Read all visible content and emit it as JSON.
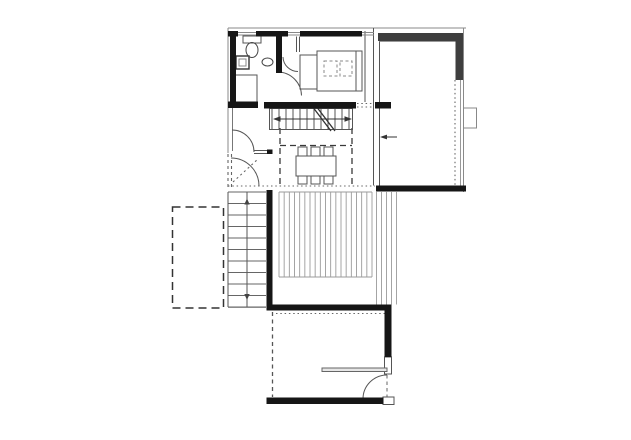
{
  "meta": {
    "canvas_width": 631,
    "canvas_height": 440,
    "background": "#ffffff",
    "drawing_type": "architectural-floor-plan"
  },
  "palette": {
    "wall_black": "#161616",
    "wall_gray": "#3e3e3e",
    "line": "#555555",
    "line_light": "#979797",
    "line_faint": "#8a8a8a",
    "dash": "#3a3a3a",
    "white": "#ffffff",
    "partition_fill": "#e6e6e6",
    "arrow": "#333333"
  },
  "plan": {
    "line_groups": [
      {
        "name": "interior-stair-treads",
        "dir": "v",
        "start": 272,
        "end": 349,
        "count": 12,
        "a1": 109,
        "a2": 129,
        "color": "#555555",
        "w": 1
      },
      {
        "name": "deck-boards",
        "dir": "v",
        "start": 279,
        "end": 372,
        "count": 19,
        "a1": 192,
        "a2": 277,
        "color": "#9b9b9b",
        "w": 0.9
      },
      {
        "name": "deck-side-steps",
        "dir": "v",
        "start": 376.5,
        "end": 396.5,
        "count": 5,
        "a1": 192,
        "a2": 304.5,
        "color": "#9b9b9b",
        "w": 0.9
      },
      {
        "name": "exterior-stair-treads",
        "dir": "h",
        "start": 192,
        "end": 307,
        "count": 11,
        "a1": 228,
        "a2": 266,
        "color": "#666666",
        "w": 1
      }
    ],
    "lines": [
      {
        "name": "roof-edge-top",
        "x1": 228,
        "y1": 28,
        "x2": 466,
        "y2": 28,
        "c": "#8a8a8a"
      },
      {
        "name": "roof-edge-left",
        "x1": 228,
        "y1": 28,
        "x2": 228,
        "y2": 153,
        "c": "#8a8a8a"
      },
      {
        "name": "left-window-inner",
        "x1": 232.5,
        "y1": 107,
        "x2": 232.5,
        "y2": 151,
        "c": "#777777"
      },
      {
        "name": "hall-wall-top",
        "x1": 254,
        "y1": 150.5,
        "x2": 268,
        "y2": 150.5
      },
      {
        "name": "hall-wall-bottom",
        "x1": 254,
        "y1": 153.5,
        "x2": 268,
        "y2": 153.5
      },
      {
        "name": "rightroom-west-wall-a",
        "x1": 373.5,
        "y1": 28,
        "x2": 373.5,
        "y2": 185.5
      },
      {
        "name": "rightroom-west-wall-b",
        "x1": 379.5,
        "y1": 41,
        "x2": 379.5,
        "y2": 185.5
      },
      {
        "name": "rightroom-east-outer",
        "x1": 463.5,
        "y1": 28,
        "x2": 463.5,
        "y2": 192,
        "c": "#8a8a8a"
      },
      {
        "name": "rightroom-east-inner",
        "x1": 460.5,
        "y1": 80,
        "x2": 460.5,
        "y2": 185.5,
        "c": "#999999"
      },
      {
        "name": "rightroom-north-inner",
        "x1": 379.5,
        "y1": 41.5,
        "x2": 455.5,
        "y2": 41.5,
        "c": "#999999"
      },
      {
        "name": "bed-foot-line",
        "x1": 356,
        "y1": 51,
        "x2": 356,
        "y2": 91
      },
      {
        "name": "bedroom-east-wall",
        "x1": 365,
        "y1": 31,
        "x2": 365,
        "y2": 102
      },
      {
        "name": "closet-stub-wall-a",
        "x1": 296.5,
        "y1": 36.5,
        "x2": 296.5,
        "y2": 52
      },
      {
        "name": "closet-stub-wall-b",
        "x1": 299.5,
        "y1": 36.5,
        "x2": 299.5,
        "y2": 52
      },
      {
        "name": "stair-direction-line",
        "x1": 279,
        "y1": 119,
        "x2": 346,
        "y2": 119,
        "c": "#333333"
      },
      {
        "name": "exterior-stair-left-edge",
        "x1": 228,
        "y1": 192,
        "x2": 228,
        "y2": 307
      },
      {
        "name": "exterior-stair-center-line",
        "x1": 247,
        "y1": 192,
        "x2": 247,
        "y2": 307
      },
      {
        "name": "exterior-stair-bottom-edge",
        "x1": 228,
        "y1": 307.5,
        "x2": 266,
        "y2": 307.5,
        "c": "#8a8a8a"
      },
      {
        "name": "deck-north-edge",
        "x1": 279,
        "y1": 192,
        "x2": 372,
        "y2": 192,
        "c": "#9b9b9b"
      },
      {
        "name": "deck-south-edge",
        "x1": 279,
        "y1": 277,
        "x2": 372,
        "y2": 277,
        "c": "#9b9b9b"
      },
      {
        "name": "window-1-glass-a",
        "x1": 238,
        "y1": 32.5,
        "x2": 256,
        "y2": 32.5,
        "c": "#888888"
      },
      {
        "name": "window-1-glass-b",
        "x1": 238,
        "y1": 35,
        "x2": 256,
        "y2": 35,
        "c": "#888888"
      },
      {
        "name": "window-2-glass-a",
        "x1": 288,
        "y1": 32.5,
        "x2": 300,
        "y2": 32.5,
        "c": "#888888"
      },
      {
        "name": "window-2-glass-b",
        "x1": 288,
        "y1": 35,
        "x2": 300,
        "y2": 35,
        "c": "#888888"
      },
      {
        "name": "window-3-glass-a",
        "x1": 362,
        "y1": 32.5,
        "x2": 374,
        "y2": 32.5,
        "c": "#888888"
      },
      {
        "name": "window-3-glass-b",
        "x1": 362,
        "y1": 35,
        "x2": 374,
        "y2": 35,
        "c": "#888888"
      },
      {
        "name": "slider-arrow-line",
        "x1": 384,
        "y1": 137,
        "x2": 397,
        "y2": 137,
        "c": "#333333"
      }
    ],
    "dotted_lines": [
      {
        "name": "main-floor-south-dotted-edge",
        "x1": 228,
        "y1": 186,
        "x2": 375,
        "y2": 186,
        "dash": "1.5,2.8"
      },
      {
        "name": "rightroom-east-dotted-edge",
        "x1": 455,
        "y1": 80,
        "x2": 455,
        "y2": 185.5,
        "dash": "1.5,2.8"
      },
      {
        "name": "lowerroom-north-dotted-line",
        "x1": 276,
        "y1": 313.5,
        "x2": 388,
        "y2": 313.5,
        "dash": "1.5,2.8"
      },
      {
        "name": "stair-gap-dotted-a",
        "x1": 357,
        "y1": 103.5,
        "x2": 373,
        "y2": 103.5,
        "dash": "1.5,2.8"
      },
      {
        "name": "stair-gap-dotted-b",
        "x1": 357,
        "y1": 107,
        "x2": 373,
        "y2": 107,
        "dash": "1.5,2.8"
      },
      {
        "name": "entry-diagonal-dotted",
        "x1": 233,
        "y1": 182,
        "x2": 258,
        "y2": 159,
        "dash": "2,3"
      },
      {
        "name": "left-open-edge-dashed-a",
        "x1": 228,
        "y1": 154,
        "x2": 228,
        "y2": 187,
        "dash": "3,3"
      },
      {
        "name": "left-open-edge-dashed-b",
        "x1": 231.5,
        "y1": 154,
        "x2": 231.5,
        "y2": 187,
        "dash": "3,3"
      }
    ],
    "dashed_lines": [
      {
        "name": "void-outline-left",
        "x1": 280,
        "y1": 128,
        "x2": 280,
        "y2": 185.5,
        "dash": "6,4",
        "c": "#3a3a3a",
        "w": 1.3
      },
      {
        "name": "void-outline-right",
        "x1": 352,
        "y1": 128,
        "x2": 352,
        "y2": 185.5,
        "dash": "6,4",
        "c": "#3a3a3a",
        "w": 1.3
      },
      {
        "name": "void-outline-top",
        "x1": 280,
        "y1": 145.5,
        "x2": 352,
        "y2": 145.5,
        "dash": "6,4",
        "c": "#3a3a3a",
        "w": 1.3
      },
      {
        "name": "lowerroom-west-dashed-wall",
        "x1": 272.5,
        "y1": 312,
        "x2": 272.5,
        "y2": 397,
        "dash": "4,3.5",
        "c": "#555555",
        "w": 1.3
      },
      {
        "name": "lower-door-leaf-dashed",
        "x1": 387,
        "y1": 375,
        "x2": 387,
        "y2": 398,
        "dash": "3.5,3",
        "c": "#666666",
        "w": 1
      }
    ],
    "dashed_rects": [
      {
        "name": "carport-dashed-outline",
        "x": 172.5,
        "y": 207,
        "w": 51,
        "h": 101,
        "dash": "8,5",
        "c": "#333333",
        "sw": 1.5
      },
      {
        "name": "bed-pillow-1",
        "x": 324,
        "y": 61,
        "w": 13,
        "h": 15,
        "dash": "3,2.5",
        "c": "#888888",
        "sw": 1
      },
      {
        "name": "bed-pillow-2",
        "x": 340,
        "y": 61,
        "w": 12,
        "h": 15,
        "dash": "3,2.5",
        "c": "#888888",
        "sw": 1
      }
    ],
    "thin_rects": [
      {
        "name": "toilet-tank",
        "x": 243,
        "y": 36,
        "w": 18,
        "h": 7
      },
      {
        "name": "vanity-cabinet",
        "x": 236,
        "y": 56,
        "w": 13,
        "h": 13,
        "c": "#333333",
        "sw": 1.4
      },
      {
        "name": "vanity-cabinet-inner",
        "x": 239,
        "y": 59,
        "w": 7,
        "h": 7,
        "c": "#888888"
      },
      {
        "name": "shower",
        "x": 234,
        "y": 75,
        "w": 23,
        "h": 28
      },
      {
        "name": "bed-headboard",
        "x": 300,
        "y": 55,
        "w": 17,
        "h": 34
      },
      {
        "name": "bed",
        "x": 317,
        "y": 51,
        "w": 45,
        "h": 40
      },
      {
        "name": "dining-table",
        "x": 296,
        "y": 156,
        "w": 40,
        "h": 20
      },
      {
        "name": "dining-chair-1",
        "x": 298,
        "y": 147,
        "w": 9,
        "h": 9
      },
      {
        "name": "dining-chair-2",
        "x": 311,
        "y": 147,
        "w": 9,
        "h": 9
      },
      {
        "name": "dining-chair-3",
        "x": 324,
        "y": 147,
        "w": 9,
        "h": 9
      },
      {
        "name": "dining-chair-4",
        "x": 298,
        "y": 176,
        "w": 9,
        "h": 8
      },
      {
        "name": "dining-chair-5",
        "x": 311,
        "y": 176,
        "w": 9,
        "h": 8
      },
      {
        "name": "dining-chair-6",
        "x": 324,
        "y": 176,
        "w": 9,
        "h": 8
      },
      {
        "name": "east-window-box",
        "x": 463.5,
        "y": 108,
        "w": 13,
        "h": 20,
        "c": "#888888"
      },
      {
        "name": "interior-stair-outline",
        "x": 269.5,
        "y": 108.5,
        "w": 83,
        "h": 21
      },
      {
        "name": "lowerroom-east-wall-segment",
        "x": 384.5,
        "y": 357,
        "w": 7,
        "h": 17,
        "fill": "#ffffff",
        "c": "#555555"
      },
      {
        "name": "lower-door-threshold-step",
        "x": 383,
        "y": 397,
        "w": 11,
        "h": 7.5,
        "fill": "#ffffff",
        "c": "#555555"
      },
      {
        "name": "lowerroom-partition-wall",
        "x": 322,
        "y": 368,
        "w": 65,
        "h": 3.5,
        "fill": "#e6e6e6",
        "c": "#666666"
      }
    ],
    "ellipses": [
      {
        "name": "toilet-bowl",
        "cx": 252,
        "cy": 50,
        "rx": 6,
        "ry": 7.5,
        "c": "#444444"
      },
      {
        "name": "wash-basin",
        "cx": 267.5,
        "cy": 62,
        "rx": 5.5,
        "ry": 4,
        "c": "#444444"
      }
    ],
    "paths": [
      {
        "name": "bedroom-door-arc",
        "d": "M 283,57 A 15 15 0 0 0 298,71.5",
        "stroke": "#555555"
      },
      {
        "name": "hall-door-arc",
        "d": "M 278,72 A 24 24 0 0 1 301.5,95.5",
        "stroke": "#555555"
      },
      {
        "name": "entry-door-arc-upper",
        "d": "M 232,130 A 22 22 0 0 1 254,152",
        "stroke": "#555555"
      },
      {
        "name": "entry-door-arc-lower",
        "d": "M 231,158 A 28 28 0 0 1 259,186",
        "stroke": "#555555"
      },
      {
        "name": "lower-door-arc",
        "d": "M 363,399 A 24 24 0 0 1 387,375",
        "stroke": "#555555"
      },
      {
        "name": "stair-break-line-a",
        "d": "M 312,106 L 331,131",
        "stroke": "#333333",
        "sw": 1.3
      },
      {
        "name": "stair-break-line-b",
        "d": "M 316,106 L 335,131",
        "stroke": "#333333",
        "sw": 1.3
      },
      {
        "name": "stair-arrowhead-left",
        "d": "M 273,119 L 280.5,116.2 L 280.5,121.8 Z",
        "fill": "#333333"
      },
      {
        "name": "stair-arrowhead-right",
        "d": "M 352,119 L 344.5,116.2 L 344.5,121.8 Z",
        "fill": "#333333"
      },
      {
        "name": "slider-arrowhead",
        "d": "M 380,137 L 387,134.6 L 387,139.4 Z",
        "fill": "#333333"
      },
      {
        "name": "exterior-stair-arrow-up",
        "d": "M 247,198.5 L 244.3,204.5 L 249.7,204.5 Z",
        "fill": "#444444"
      },
      {
        "name": "exterior-stair-arrow-down",
        "d": "M 247,300 L 244.3,294 L 249.7,294 Z",
        "fill": "#444444"
      }
    ],
    "walls_gray": [
      {
        "name": "rightroom-north-wall",
        "x": 378,
        "y": 33,
        "w": 84,
        "h": 8
      },
      {
        "name": "rightroom-east-wall",
        "x": 455.5,
        "y": 33,
        "w": 7.5,
        "h": 47
      }
    ],
    "walls_black": [
      {
        "name": "bathroom-west-wall",
        "x": 230,
        "y": 31,
        "w": 6,
        "h": 76
      },
      {
        "name": "top-wall-segment-a",
        "x": 228,
        "y": 31,
        "w": 10,
        "h": 5.5
      },
      {
        "name": "top-wall-segment-b",
        "x": 256,
        "y": 31,
        "w": 32,
        "h": 5.5
      },
      {
        "name": "top-wall-segment-c",
        "x": 300,
        "y": 31,
        "w": 62,
        "h": 5.5
      },
      {
        "name": "bathroom-east-wall",
        "x": 276,
        "y": 36,
        "w": 6,
        "h": 37
      },
      {
        "name": "hall-south-wall",
        "x": 228,
        "y": 101.5,
        "w": 30,
        "h": 6.5
      },
      {
        "name": "stair-north-wall",
        "x": 264,
        "y": 102,
        "w": 92,
        "h": 6.5
      },
      {
        "name": "rightroom-west-stub-wall",
        "x": 375,
        "y": 102,
        "w": 16,
        "h": 6.5
      },
      {
        "name": "rightroom-south-wall",
        "x": 376,
        "y": 185.5,
        "w": 90,
        "h": 6
      },
      {
        "name": "entry-stub-wall",
        "x": 267,
        "y": 149.5,
        "w": 5.5,
        "h": 4.5
      },
      {
        "name": "deck-west-wall",
        "x": 266.5,
        "y": 190,
        "w": 6,
        "h": 120
      },
      {
        "name": "lowerroom-north-wall",
        "x": 266.5,
        "y": 304.5,
        "w": 125,
        "h": 6
      },
      {
        "name": "lowerroom-east-wall",
        "x": 384.5,
        "y": 304.5,
        "w": 7,
        "h": 52.5
      },
      {
        "name": "lowerroom-south-wall",
        "x": 266.5,
        "y": 397.5,
        "w": 117,
        "h": 6.5
      }
    ]
  }
}
